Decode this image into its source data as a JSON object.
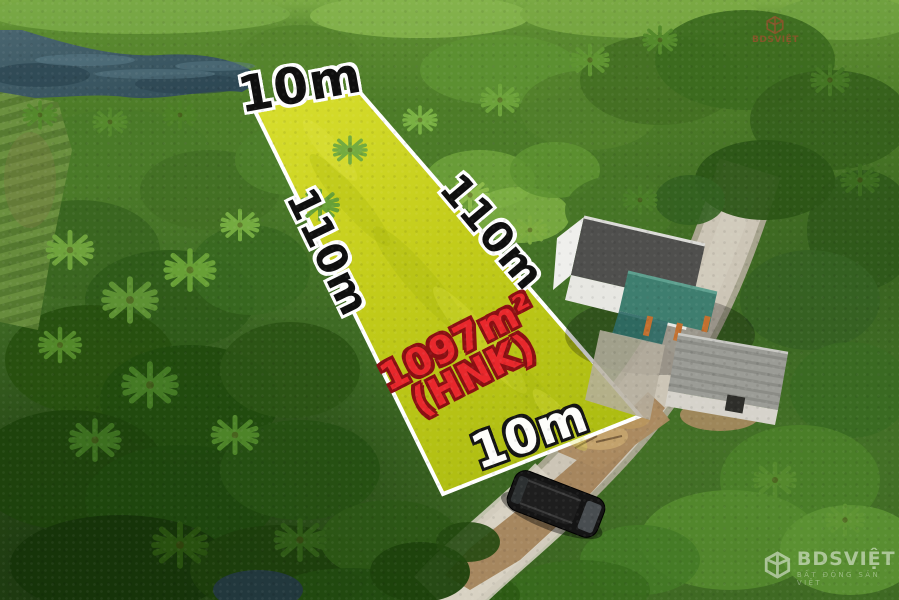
{
  "labels": {
    "width_top": "10m",
    "length_left": "110m",
    "length_right": "110m",
    "width_bottom": "10m",
    "area": "1097m²",
    "land_code": "(HNK)"
  },
  "watermark": {
    "brand": "BDSVIỆT",
    "tagline": "BẤT ĐỘNG SẢN VIỆT"
  },
  "colors": {
    "plot_fill": "#c6cf1b",
    "plot_border": "#ffffff",
    "dimension_text": "#0f0f0f",
    "dimension_outline": "#ffffff",
    "bottom_dimension_text": "#fdfdfa",
    "bottom_dimension_outline": "#141414",
    "area_text": "#e8282c",
    "area_outline": "#8a1013",
    "watermark_white": "#ffffff",
    "watermark_red": "#c94034",
    "pond_water": "#3c5a66",
    "road_surface": "#ccc5b6",
    "dirt": "#a3835a",
    "canopy_green": "#477629"
  }
}
